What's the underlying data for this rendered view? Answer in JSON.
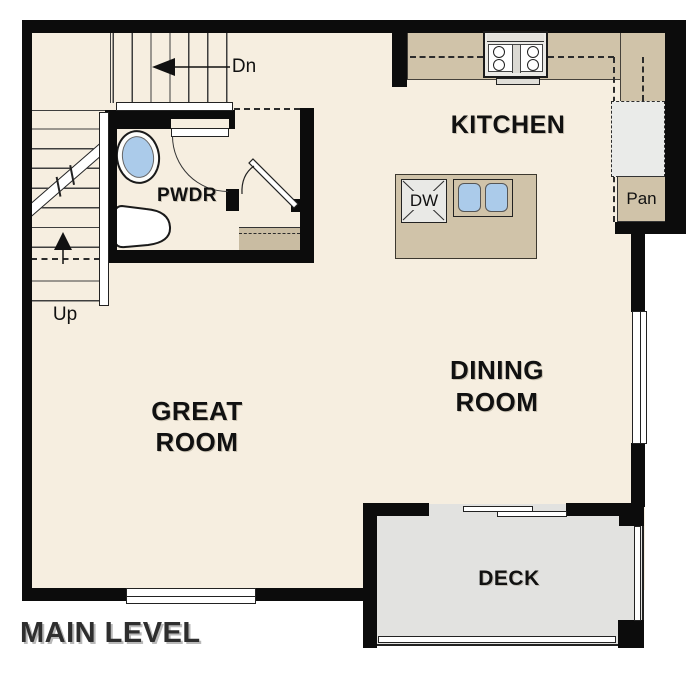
{
  "title": "MAIN LEVEL",
  "rooms": {
    "kitchen": "KITCHEN",
    "dining1": "DINING",
    "dining2": "ROOM",
    "great1": "GREAT",
    "great2": "ROOM",
    "powder": "PWDR",
    "deck": "DECK"
  },
  "fixtures": {
    "dishwasher": "DW",
    "pantry": "Pan"
  },
  "stairs": {
    "up": "Up",
    "down": "Dn"
  },
  "colors": {
    "page": "#ffffff",
    "floor": "#f6eee0",
    "wall": "#0c0c0c",
    "counter": "#d0c3a9",
    "shelf": "#c9bca2",
    "deck": "#e2e2e0",
    "appliance": "#e9e9e6",
    "fridge": "#eaebe9",
    "blue": "#abcbea",
    "line": "#333333",
    "label": "#111111",
    "title": "#2e2e2e"
  }
}
